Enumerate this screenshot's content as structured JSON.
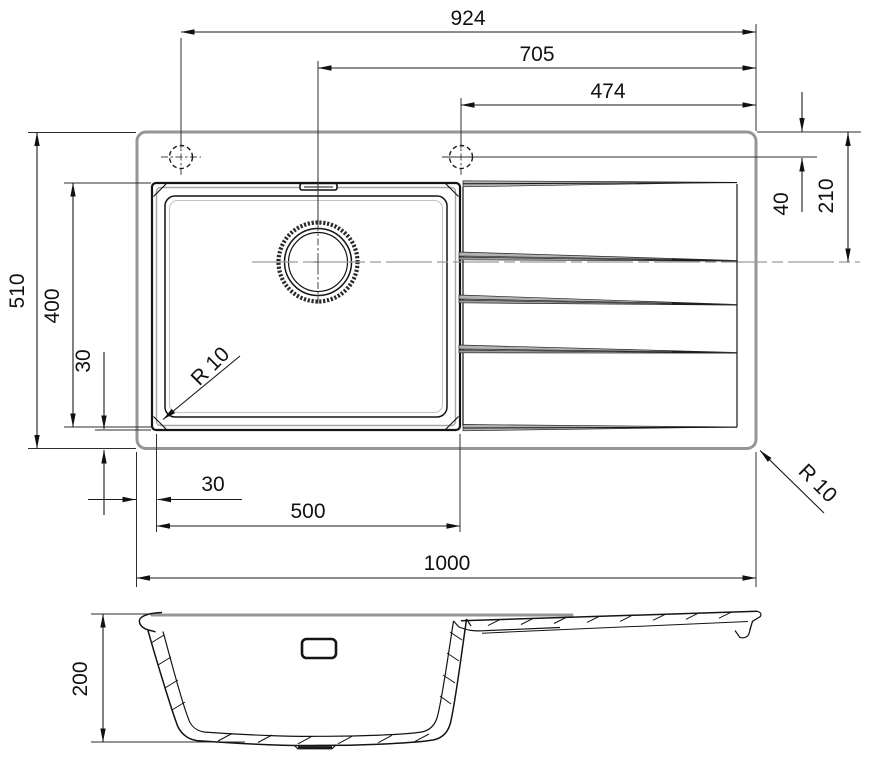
{
  "drawing": {
    "subject": "kitchen sink with single bowl and drainboard",
    "views": [
      "top view",
      "front section view"
    ]
  },
  "colors": {
    "background": "#ffffff",
    "line": "#141414",
    "outline_gray": "#969696",
    "groove_fill": "#b2b2b2"
  },
  "dims": {
    "d924": "924",
    "d705": "705",
    "d474": "474",
    "d40": "40",
    "d210": "210",
    "d510": "510",
    "d400": "400",
    "d30_left": "30",
    "d30_bottom": "30",
    "d500": "500",
    "d1000": "1000",
    "d200": "200",
    "r10_bowl": "R 10",
    "r10_corner": "R 10"
  }
}
